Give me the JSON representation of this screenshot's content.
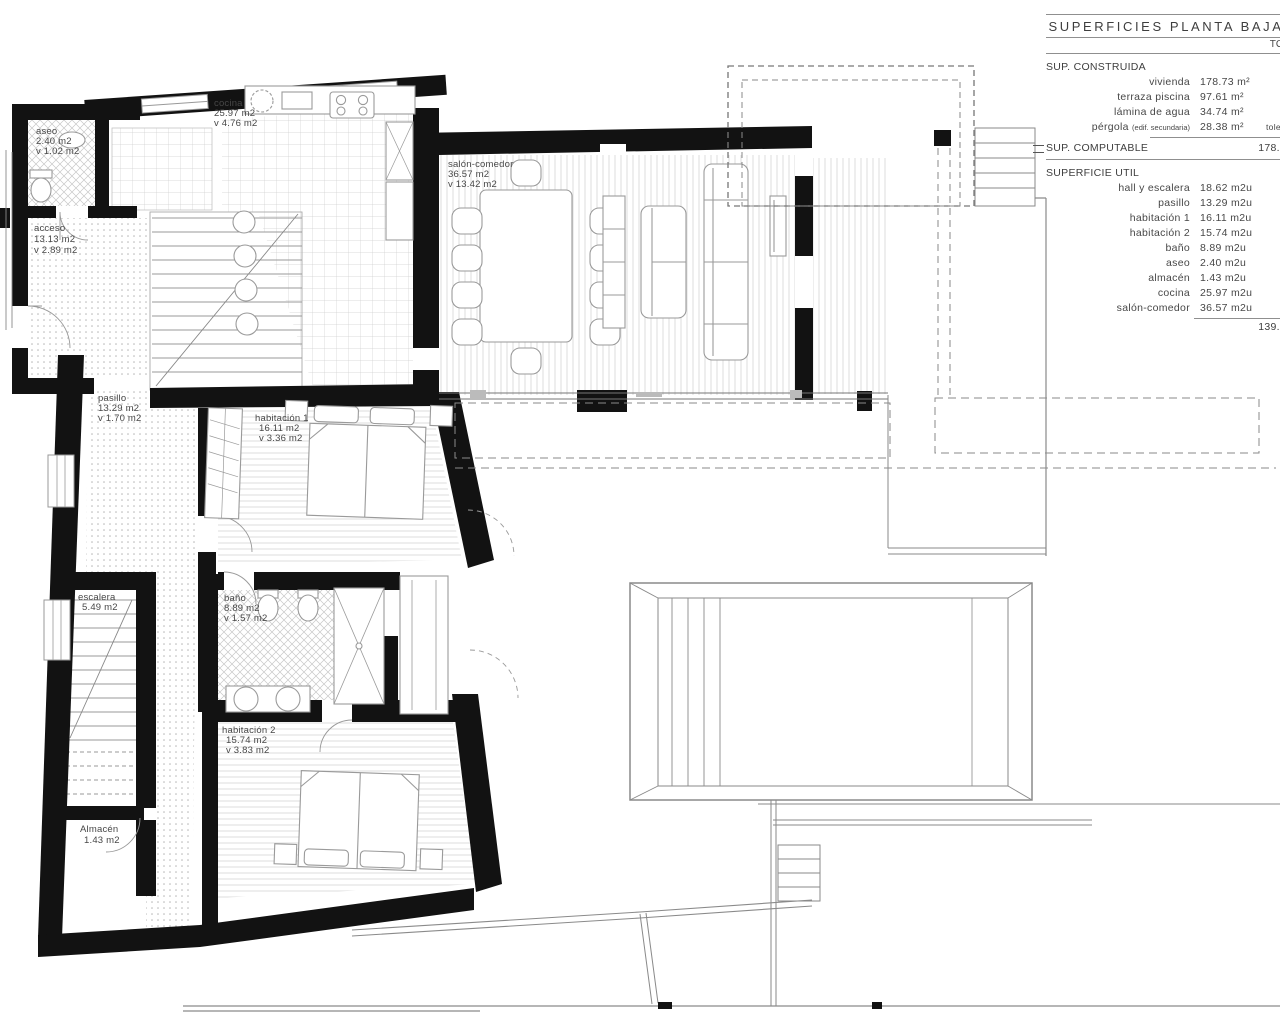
{
  "table": {
    "title": "SUPERFICIES PLANTA BAJA",
    "header_right": "TO",
    "sup_construida": {
      "label": "SUP. CONSTRUIDA",
      "rows": [
        {
          "name": "vivienda",
          "value": "178.73 m²",
          "extra": ""
        },
        {
          "name": "terraza piscina",
          "value": "97.61 m²",
          "extra": ""
        },
        {
          "name": "lámina de agua",
          "value": "34.74 m²",
          "extra": ""
        },
        {
          "name": "pérgola",
          "note": "(edif. secundaria)",
          "value": "28.38 m²",
          "extra": "toler"
        }
      ]
    },
    "sup_computable": {
      "label": "SUP. COMPUTABLE",
      "value": "178.7"
    },
    "superficie_util": {
      "label": "SUPERFICIE UTIL",
      "rows": [
        {
          "name": "hall y escalera",
          "value": "18.62 m2u"
        },
        {
          "name": "pasillo",
          "value": "13.29 m2u"
        },
        {
          "name": "habitación 1",
          "value": "16.11 m2u"
        },
        {
          "name": "habitación 2",
          "value": "15.74 m2u"
        },
        {
          "name": "baño",
          "value": "8.89 m2u"
        },
        {
          "name": "aseo",
          "value": "2.40 m2u"
        },
        {
          "name": "almacén",
          "value": "1.43 m2u"
        },
        {
          "name": "cocina",
          "value": "25.97 m2u"
        },
        {
          "name": "salón-comedor",
          "value": "36.57 m2u"
        }
      ],
      "total": "139.0"
    }
  },
  "plan": {
    "rooms": [
      {
        "label": "aseo",
        "area": "2.40 m2",
        "vent": "v 1.02 m2"
      },
      {
        "label": "acceso",
        "area": "13.13 m2",
        "vent": "v 2.89 m2"
      },
      {
        "label": "cocina",
        "area": "25.97 m2",
        "vent": "v 4.76 m2"
      },
      {
        "label": "salón-comedor",
        "area": "36.57 m2",
        "vent": "v 13.42 m2"
      },
      {
        "label": "pasillo",
        "area": "13.29 m2",
        "vent": "v 1.70 m2"
      },
      {
        "label": "habitación 1",
        "area": "16.11 m2",
        "vent": "v 3.36 m2"
      },
      {
        "label": "escalera",
        "area": "5.49 m2",
        "vent": ""
      },
      {
        "label": "baño",
        "area": "8.89 m2",
        "vent": "v 1.57 m2"
      },
      {
        "label": "habitación 2",
        "area": "15.74 m2",
        "vent": "v 3.83 m2"
      },
      {
        "label": "Almacén",
        "area": "1.43 m2",
        "vent": ""
      }
    ],
    "colors": {
      "wall": "#121212",
      "line": "#8f8f8f",
      "ink": "#474747"
    }
  }
}
